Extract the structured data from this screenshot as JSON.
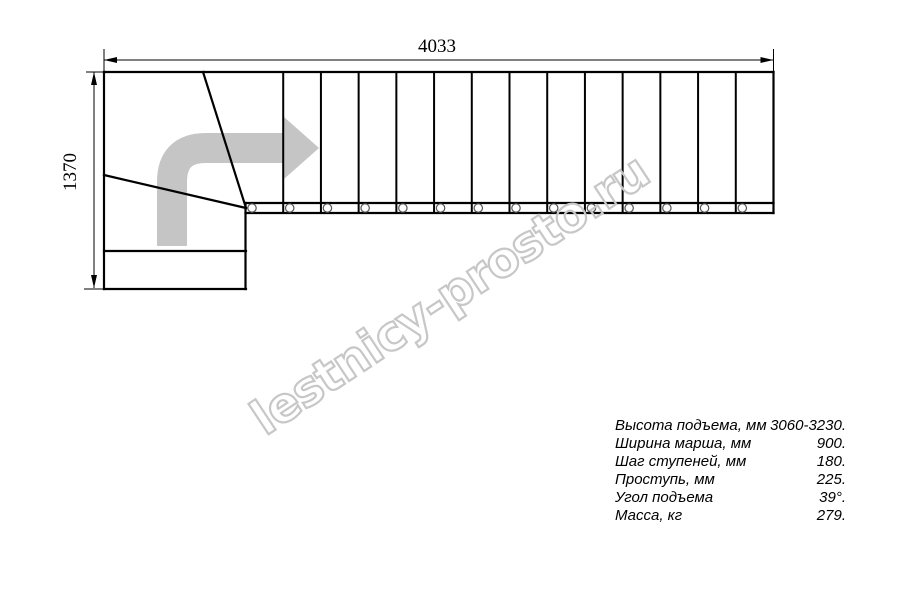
{
  "watermark": {
    "text": "lestnicy-prosto.ru",
    "color": "#c7c7c7"
  },
  "drawing": {
    "dim_width_label": "4033",
    "dim_height_label": "1370",
    "treads_straight": 14,
    "line_color": "#000000",
    "direction_arrow_color": "#c5c5c5"
  },
  "specs": {
    "rows": [
      {
        "label": "Высота подъема, мм",
        "value": "3060-3230."
      },
      {
        "label": "Ширина марша, мм",
        "value": "900."
      },
      {
        "label": "Шаг ступеней, мм",
        "value": "180."
      },
      {
        "label": "Проступь, мм",
        "value": "225."
      },
      {
        "label": "Угол подъема",
        "value": "39°."
      },
      {
        "label": "Масса, кг",
        "value": "279."
      }
    ]
  }
}
